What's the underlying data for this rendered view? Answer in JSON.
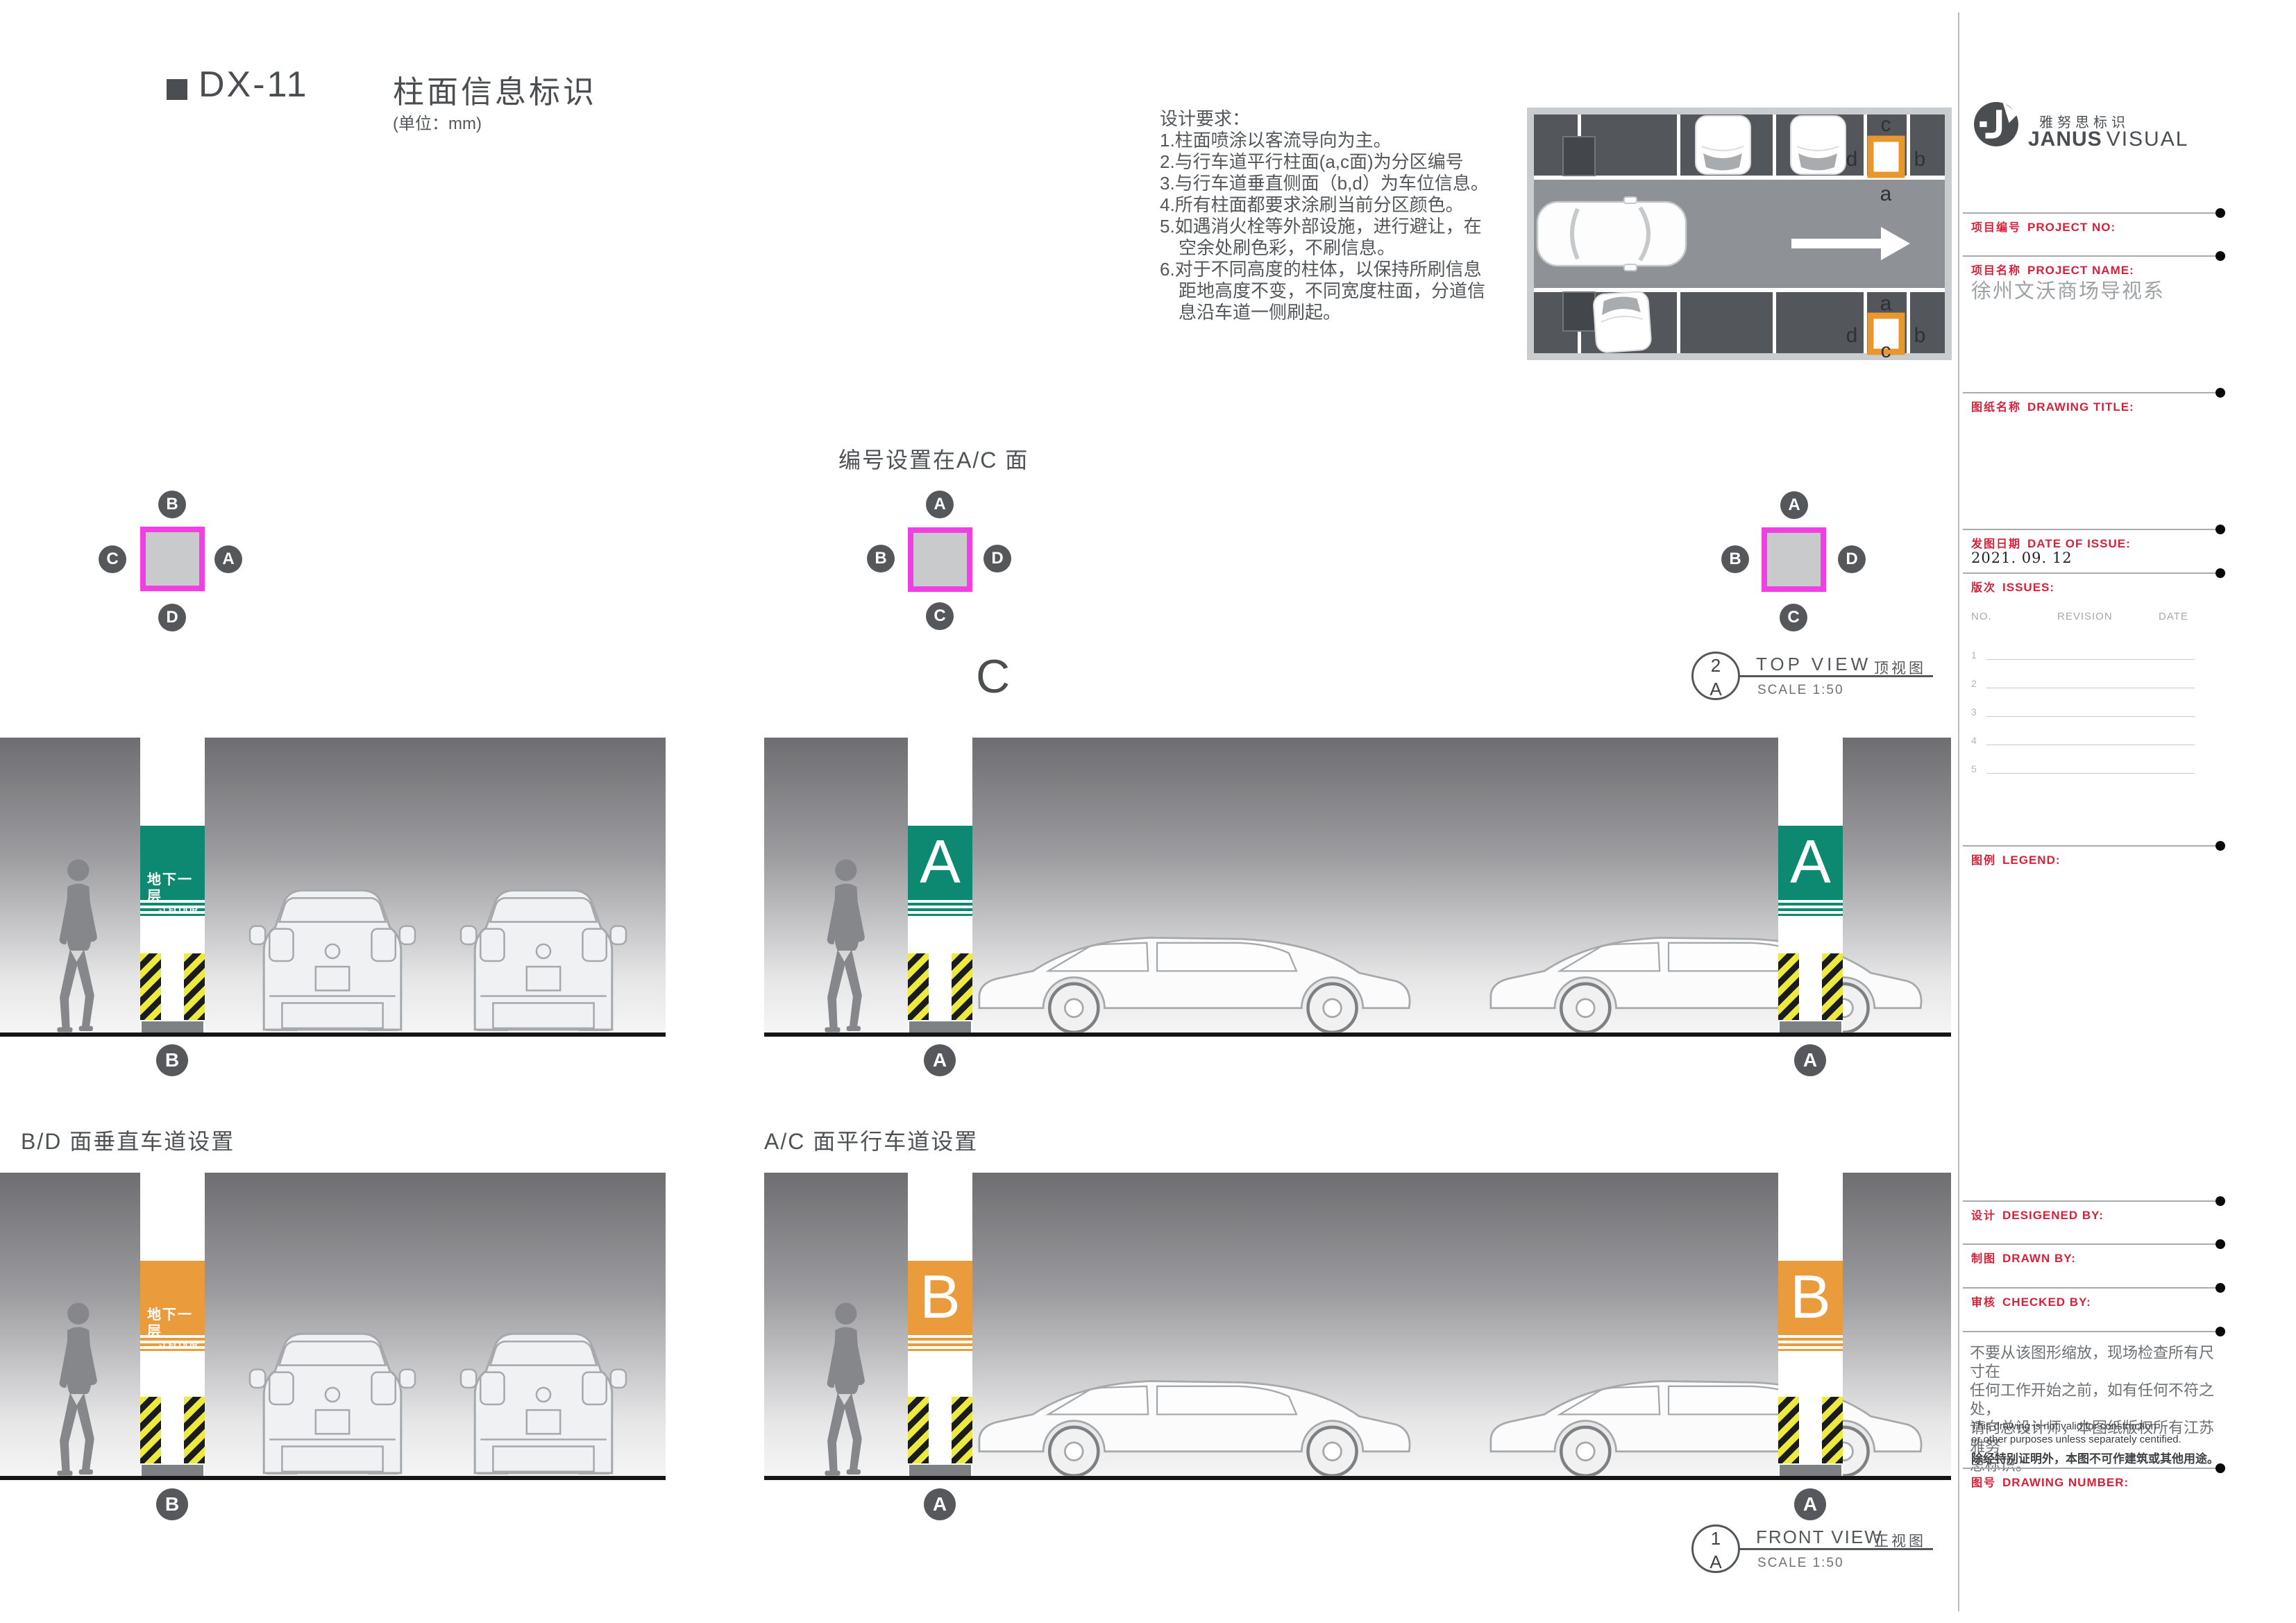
{
  "doc": {
    "code": "DX-11",
    "title": "柱面信息标识",
    "unit": "(单位：mm)"
  },
  "requirements": {
    "title": "设计要求：",
    "lines": [
      "1.柱面喷涂以客流导向为主。",
      "2.与行车道平行柱面(a,c面)为分区编号",
      "3.与行车道垂直侧面（b,d）为车位信息。",
      "4.所有柱面都要求涂刷当前分区颜色。",
      "5.如遇消火栓等外部设施，进行避让，在",
      "空余处刷色彩，不刷信息。",
      "6.对于不同高度的柱体，以保持所刷信息",
      "距地高度不变，不同宽度柱面，分道信",
      "息沿车道一侧刷起。"
    ]
  },
  "plan": {
    "top_column": {
      "top": "c",
      "left": "d",
      "right": "b",
      "bottom": "a"
    },
    "bottom_column": {
      "top": "a",
      "left": "d",
      "right": "b",
      "bottom": "c"
    }
  },
  "topviews": {
    "note": "编号设置在A/C 面",
    "zone_letter": "C",
    "left": {
      "top": "B",
      "left": "C",
      "right": "A",
      "bottom": "D"
    },
    "middle": {
      "top": "A",
      "left": "B",
      "right": "D",
      "bottom": "C"
    },
    "right": {
      "top": "A",
      "left": "B",
      "right": "D",
      "bottom": "C"
    }
  },
  "views": {
    "top": {
      "num": "2",
      "ref": "A",
      "title": "TOP VIEW",
      "title_cn": "顶视图",
      "scale": "SCALE 1:50"
    },
    "front": {
      "num": "1",
      "ref": "A",
      "title": "FRONT VIEW",
      "title_cn": "正视图",
      "scale": "SCALE 1:50"
    }
  },
  "sections": {
    "bd": "B/D 面垂直车道设置",
    "ac": "A/C 面平行车道设置"
  },
  "signs": {
    "floor_cn": "地下一层",
    "floor_en": "-1 FLOOR",
    "zone_a": "A",
    "zone_b": "B"
  },
  "elev_labels": {
    "r1": [
      "B",
      "A",
      "A"
    ],
    "r2": [
      "B",
      "A",
      "A"
    ]
  },
  "sidebar": {
    "brand_cn": "雅努思标识",
    "brand_en_bold": "JANUS",
    "brand_en_light": "VISUAL",
    "project_no_cn": "项目编号",
    "project_no_en": "PROJECT NO:",
    "project_name_cn": "项目名称",
    "project_name_en": "PROJECT NAME:",
    "project_name_value": "徐州文沃商场导视系",
    "drawing_title_cn": "图纸名称",
    "drawing_title_en": "DRAWING TITLE:",
    "date_cn": "发图日期",
    "date_en": "DATE OF ISSUE:",
    "date_value": "2021. 09. 12",
    "issues_cn": "版次",
    "issues_en": "ISSUES:",
    "rev_headers": [
      "NO.",
      "REVISION",
      "DATE"
    ],
    "rev_rows": [
      "1",
      "2",
      "3",
      "4",
      "5"
    ],
    "legend_cn": "图例",
    "legend_en": "LEGEND:",
    "designed_cn": "设计",
    "designed_en": "DESIGENED BY:",
    "drawn_cn": "制图",
    "drawn_en": "DRAWN BY:",
    "checked_cn": "审核",
    "checked_en": "CHECKED BY:",
    "note_cn": [
      "不要从该图形缩放，现场检查所有尺寸在",
      "任何工作开始之前，如有任何不符之处，",
      "请向总设计师，本图纸版权所有江苏雅努",
      "思标识。"
    ],
    "note_en": [
      "This drawing is not valid for construction",
      "or other purposes unless separately centified."
    ],
    "note_cn_bold": "除经特别证明外，本图不可作建筑或其他用途。",
    "drawing_no_cn": "图号",
    "drawing_no_en": "DRAWING NUMBER:"
  },
  "colors": {
    "zone_green": "#0E8971",
    "zone_orange": "#EA9C3C",
    "column_magenta": "#F23FE4",
    "accent_red": "#D6213A"
  }
}
